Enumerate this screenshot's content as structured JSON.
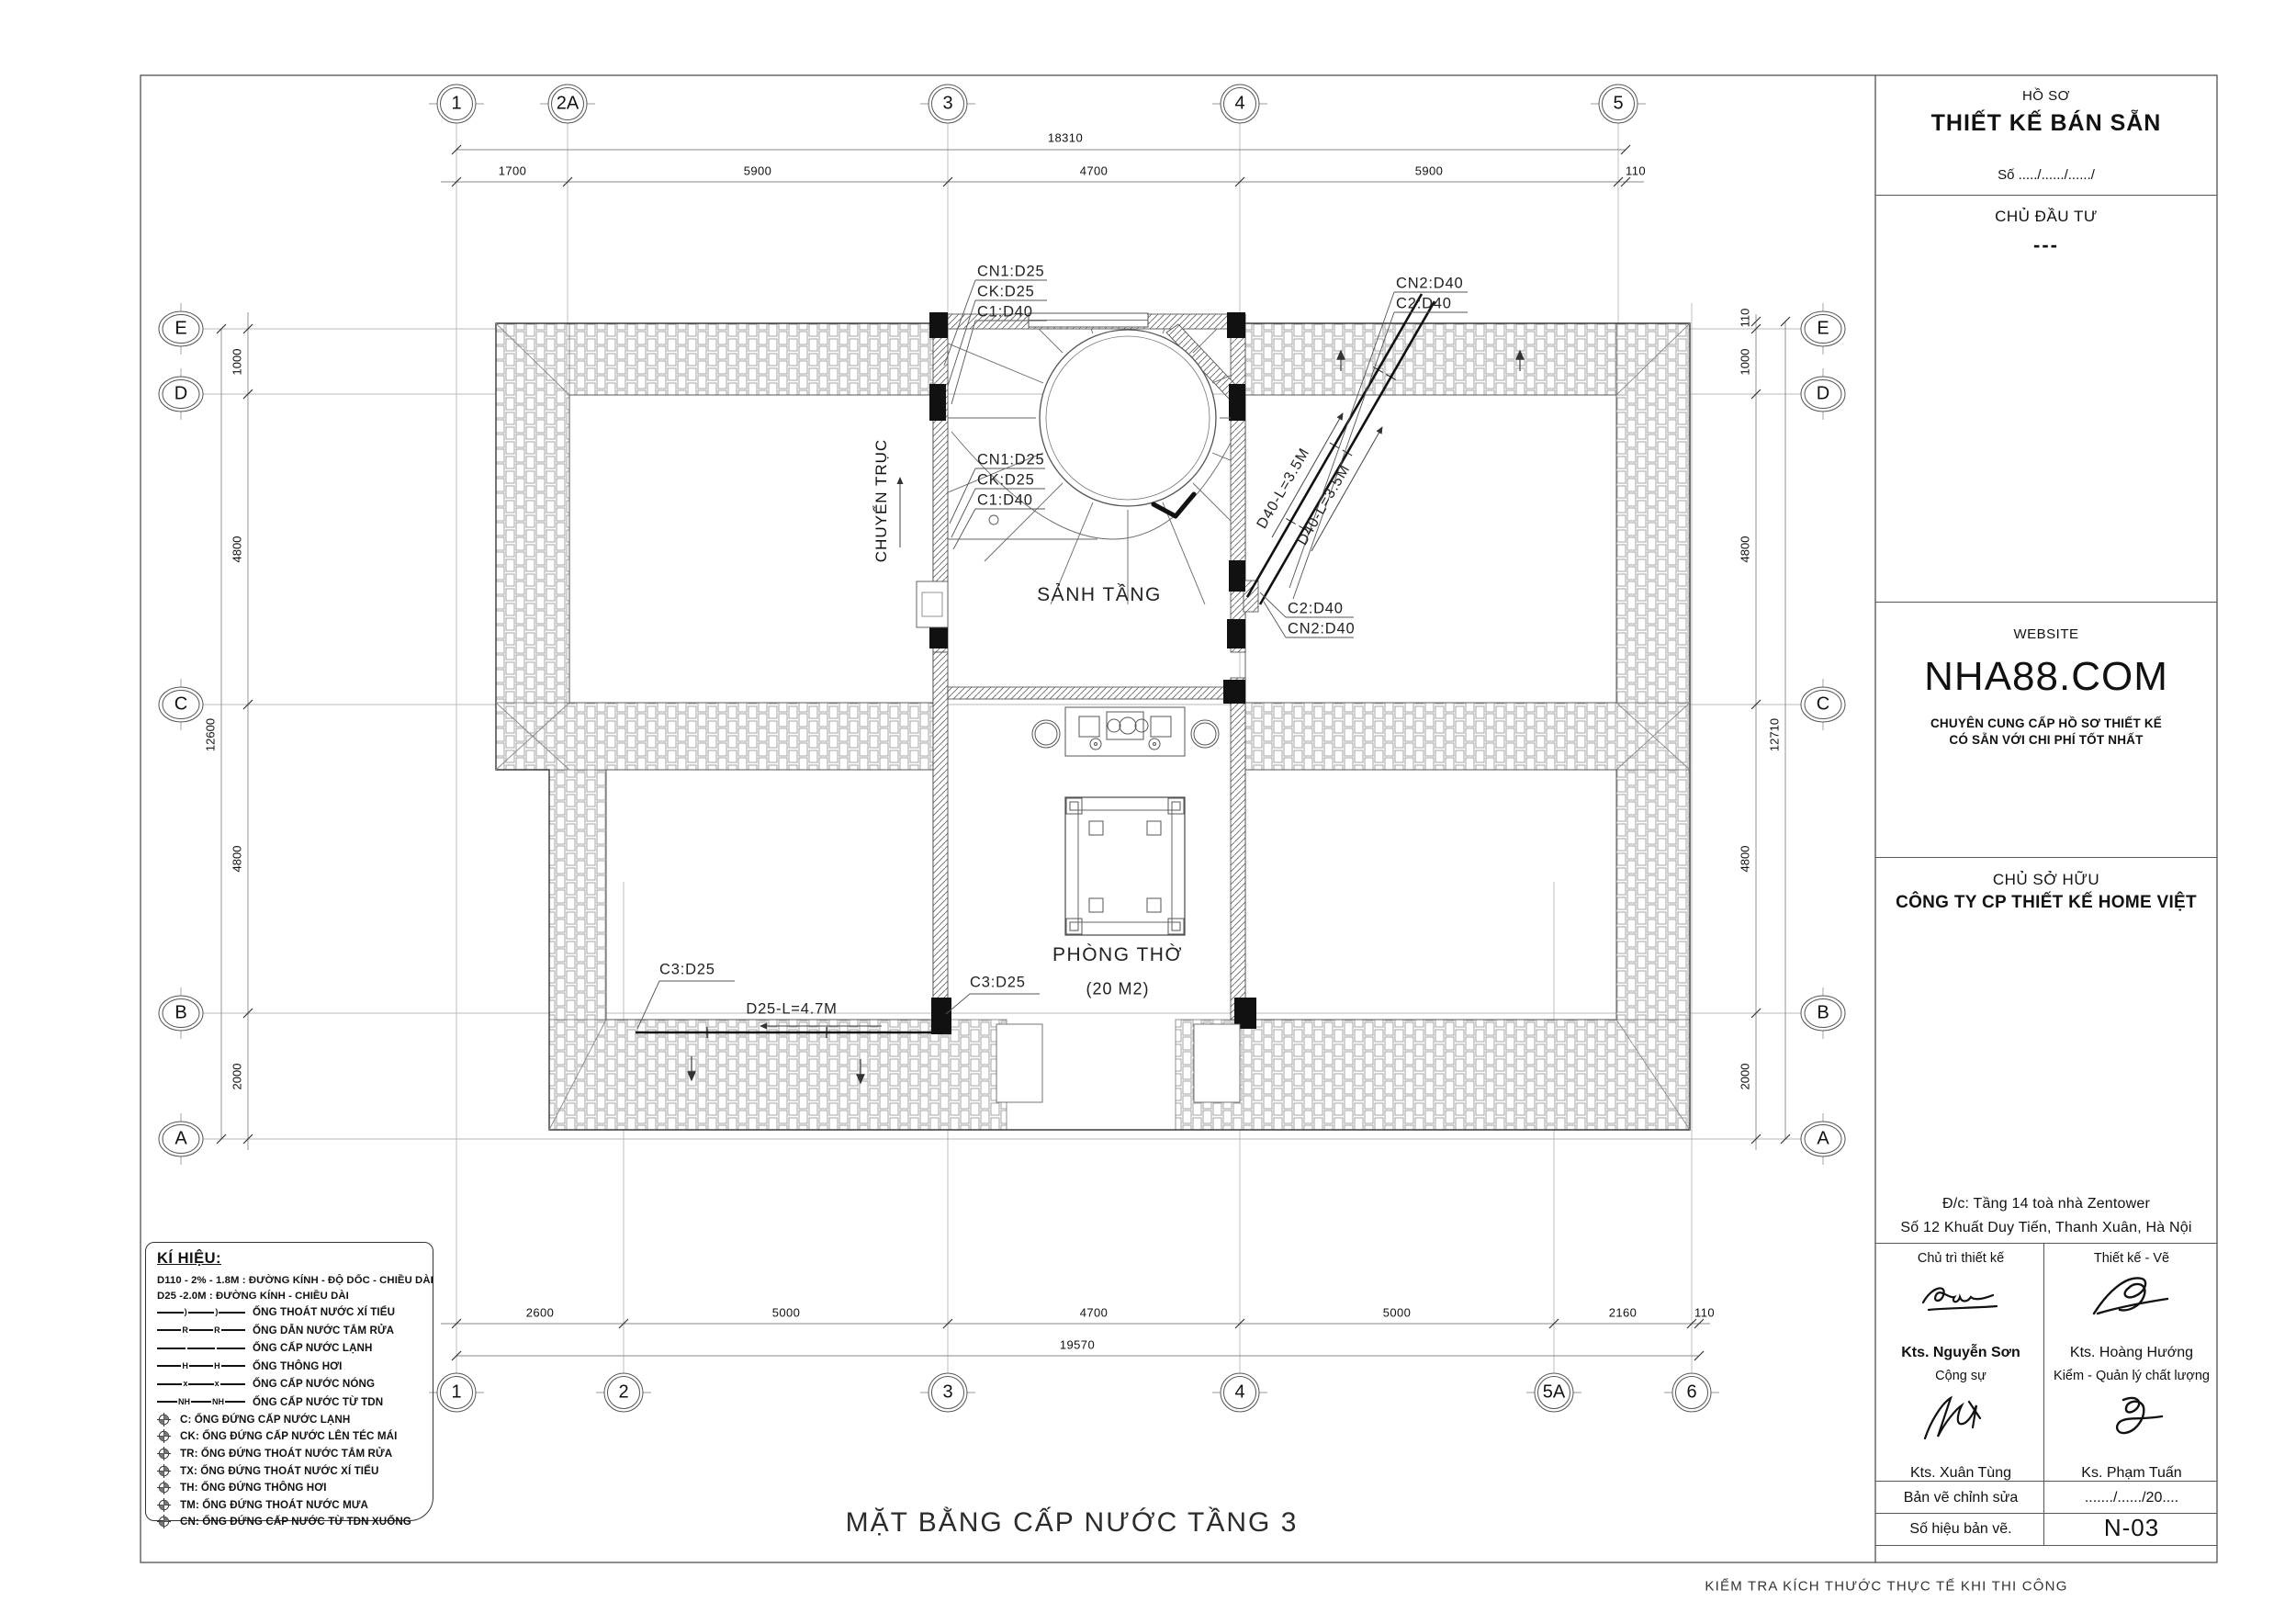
{
  "sheet": {
    "drawing_title": "MẶT BẰNG CẤP NƯỚC TẦNG 3",
    "bottom_note": "KIỂM TRA KÍCH THƯỚC THỰC TẾ KHI THI CÔNG"
  },
  "title_block": {
    "dossier_label": "HỒ SƠ",
    "dossier_title": "THIẾT KẾ BÁN SẴN",
    "dossier_number": "Số ...../....../....../",
    "investor_label": "CHỦ ĐẦU TƯ",
    "investor_value": "---",
    "website_label": "WEBSITE",
    "website_domain": "NHA88.COM",
    "website_slogan1": "CHUYÊN CUNG CẤP HỒ SƠ THIẾT KẾ",
    "website_slogan2": "CÓ SẴN VỚI CHI PHÍ TỐT NHẤT",
    "owner_label": "CHỦ SỞ HỮU",
    "owner_company": "CÔNG TY CP THIẾT KẾ HOME VIỆT",
    "address1": "Đ/c: Tầng 14 toà nhà Zentower",
    "address2": "Số 12 Khuất Duy Tiến, Thanh Xuân, Hà Nội",
    "role1": "Chủ trì thiết kế",
    "name1": "Kts. Nguyễn Sơn",
    "role2": "Thiết kế - Vẽ",
    "name2": "Kts. Hoàng Hướng",
    "role3": "Cộng sự",
    "name3": "Kts. Xuân Tùng",
    "role4": "Kiểm - Quản lý chất lượng",
    "name4": "Ks. Phạm Tuấn",
    "revision_label": "Bản vẽ chỉnh sửa",
    "revision_value": "......./....../20....",
    "number_label": "Số hiệu bản vẽ.",
    "number_value": "N-03"
  },
  "legend": {
    "title": "KÍ HIỆU:",
    "notes": [
      "D110 - 2% - 1.8M :  ĐƯỜNG KÍNH - ĐỘ DỐC - CHIỀU DÀI",
      "D25 -2.0M : ĐƯỜNG KÍNH - CHIỀU DÀI"
    ],
    "lines": [
      {
        "marker": ")",
        "label": "ỐNG THOÁT NƯỚC XÍ TIỂU"
      },
      {
        "marker": "R",
        "label": "ỐNG DẪN NƯỚC TẮM RỬA"
      },
      {
        "marker": "",
        "label": "ỐNG CẤP NƯỚC LẠNH"
      },
      {
        "marker": "H",
        "label": "ỐNG THÔNG HƠI"
      },
      {
        "marker": "x",
        "label": "ỐNG CẤP NƯỚC NÓNG"
      },
      {
        "marker": "NH",
        "label": "ỐNG CẤP NƯỚC TỪ TDN"
      }
    ],
    "risers": [
      "C:   ỐNG ĐỨNG CẤP NƯỚC LẠNH",
      "CK: ỐNG ĐỨNG CẤP NƯỚC LÊN TÉC MÁI",
      "TR: ỐNG ĐỨNG THOÁT NƯỚC TẮM RỬA",
      "TX: ỐNG ĐỨNG THOÁT NƯỚC XÍ TIỂU",
      "TH: ỐNG ĐỨNG THÔNG HƠI",
      "TM: ỐNG ĐỨNG THOÁT NƯỚC MƯA",
      "CN: ỐNG ĐỨNG CẤP NƯỚC TỪ TDN XUỐNG"
    ]
  },
  "plan": {
    "grid_top": [
      "1",
      "2A",
      "3",
      "4",
      "5"
    ],
    "grid_bottom": [
      "1",
      "2",
      "3",
      "4",
      "5A",
      "6"
    ],
    "grid_left": [
      "E",
      "D",
      "C",
      "B",
      "A"
    ],
    "grid_right": [
      "E",
      "D",
      "C",
      "B",
      "A"
    ],
    "dim_top_overall": "18310",
    "dim_top": [
      "1700",
      "5900",
      "4700",
      "5900",
      "110"
    ],
    "dim_bottom_overall": "19570",
    "dim_bottom": [
      "2600",
      "5000",
      "4700",
      "5000",
      "2160",
      "110"
    ],
    "dim_left_overall": "12600",
    "dim_left": [
      "1000",
      "4800",
      "4800",
      "2000"
    ],
    "dim_right_overall": "12710",
    "dim_right": [
      "110",
      "1000",
      "4800",
      "4800",
      "2000"
    ],
    "labels": {
      "riser_stack_top": [
        "CN1:D25",
        "CK:D25",
        "C1:D40"
      ],
      "riser_stack_mid": [
        "CN1:D25",
        "CK:D25",
        "C1:D40"
      ],
      "riser_stack_topright": [
        "CN2:D40",
        "C2:D40"
      ],
      "riser_stack_midright": [
        "C2:D40",
        "CN2:D40"
      ],
      "pipe_diag_1": "D40-L=3.5M",
      "pipe_diag_2": "D40-L=3.5M",
      "pipe_horiz": "D25-L=4.7M",
      "c3_left": "C3:D25",
      "c3_right": "C3:D25",
      "axis_note": "CHUYỂN TRỤC"
    },
    "rooms": {
      "hall": "SẢNH TẦNG",
      "worship": "PHÒNG THỜ",
      "worship_area": "(20 M2)"
    }
  }
}
